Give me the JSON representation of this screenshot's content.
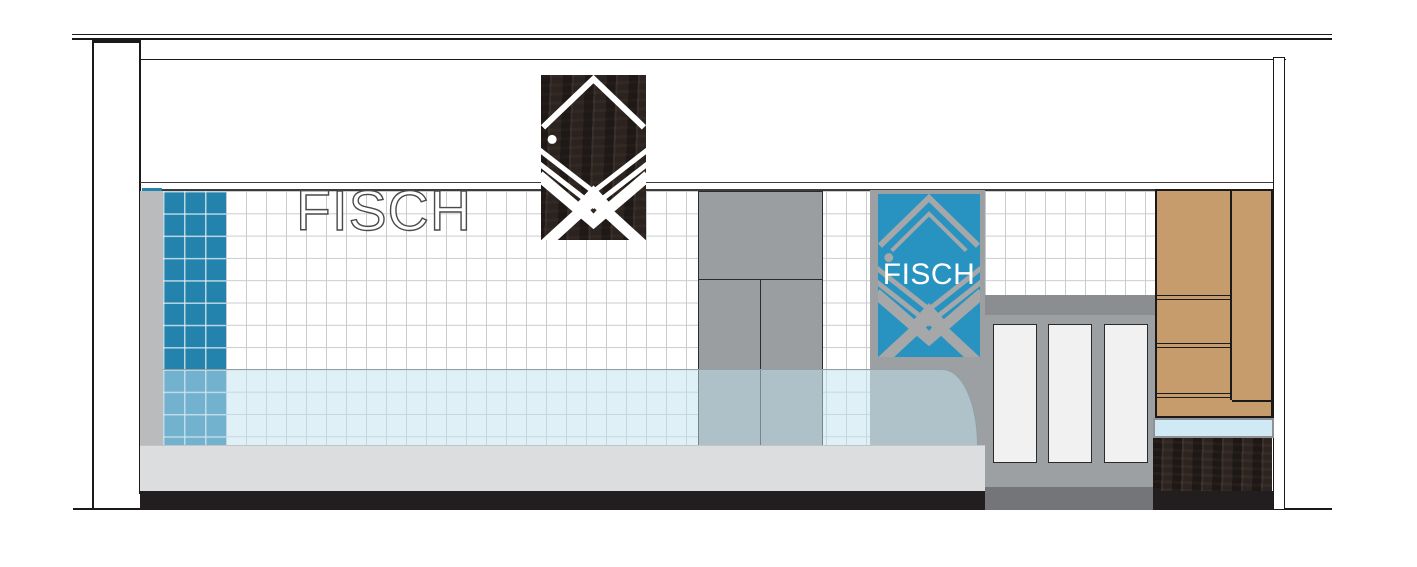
{
  "signs": {
    "wall": "FISCH",
    "panel": "FISCH"
  },
  "colors": {
    "line_dark": "#1a1a1a",
    "tile_grout": "#c9cccd",
    "blue_tile": "#2383ad",
    "panel_blue": "#2893c1",
    "logo_gray": "#a5a7a9",
    "door_gray": "#9b9ea0",
    "surround_gray": "#9da0a2",
    "counter_top_band": "#8b8d90",
    "counter_body": "#9ca0a2",
    "counter_base": "#737578",
    "counter_panel": "#f1f1f2",
    "wood_tan": "#c69c6d",
    "dark_wood": "#2b2421",
    "sign_panel_dark": "#2b2320",
    "glass_tint": "rgba(193,225,240,0.5)",
    "glass_shelf": "#cfeaf4",
    "base_gray": "#dcdddf",
    "kick_black": "#221e1f",
    "gray_strip": "#b9bbbd"
  }
}
